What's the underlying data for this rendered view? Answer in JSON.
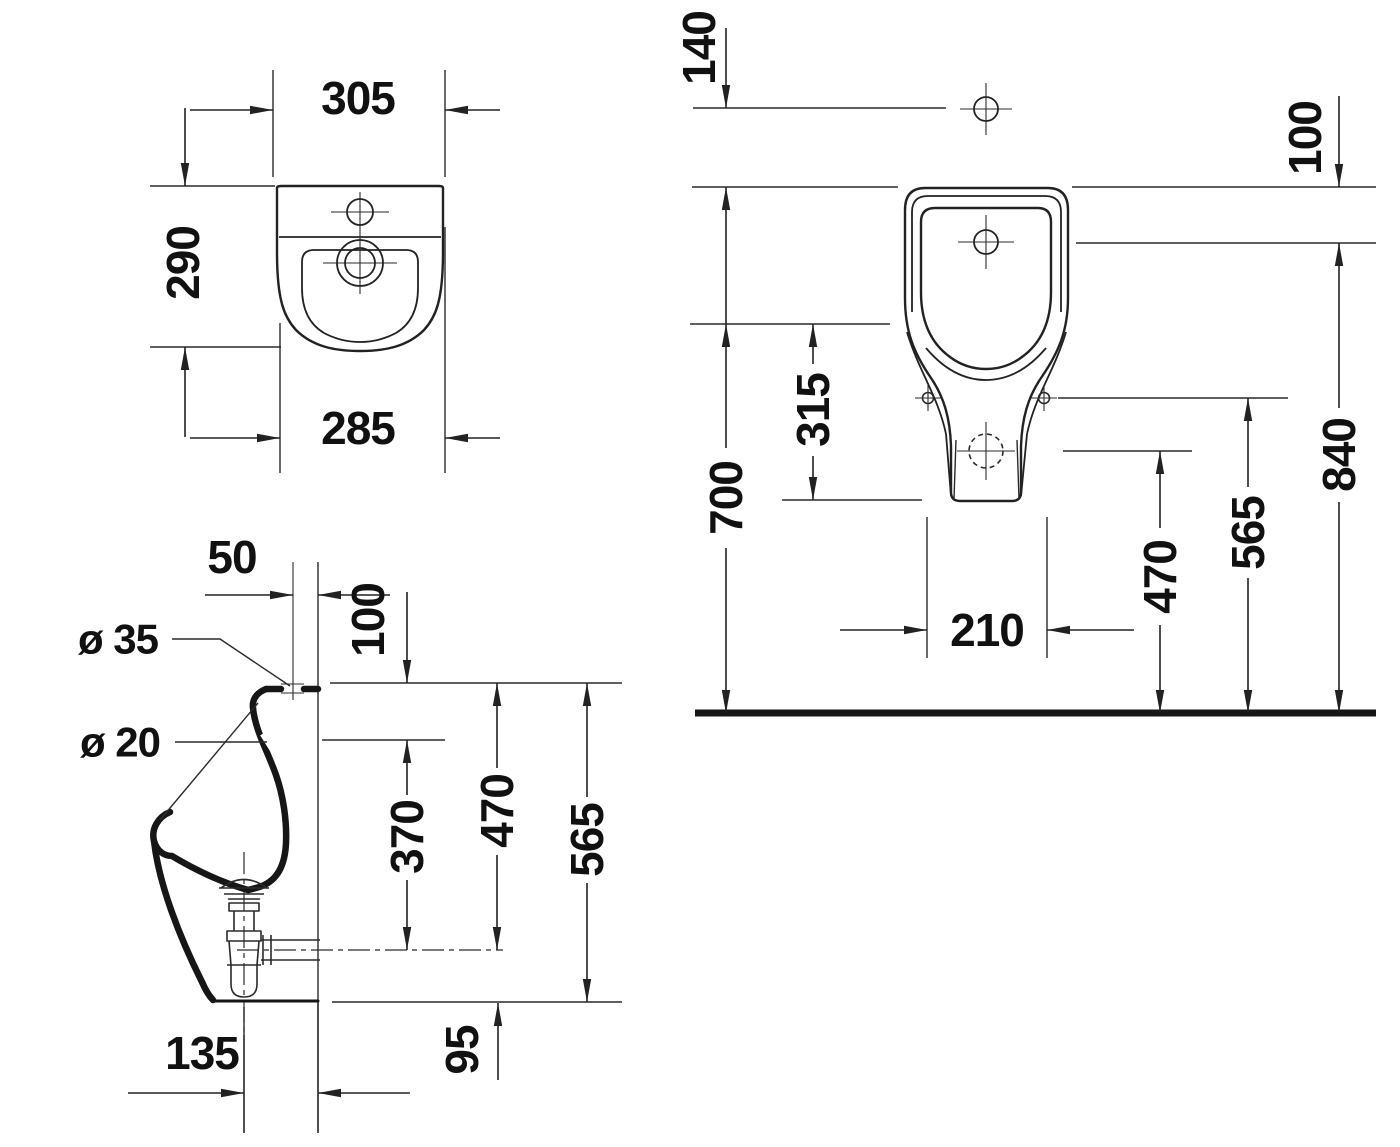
{
  "drawing": {
    "title": "Wall-hung urinal technical drawing, three orthographic views, dimensions in mm",
    "colors": {
      "background": "#ffffff",
      "line": "#222222",
      "text": "#111111"
    }
  },
  "plan": {
    "width_top": "305",
    "depth": "290",
    "width_bottom": "285"
  },
  "side": {
    "inlet_to_wall": "50",
    "rim_hole_drop": "100",
    "inlet_diameter": "ø 35",
    "rim_hole_diameter": "ø 20",
    "drain_drop": "370",
    "outlet_axis_drop": "470",
    "body_height": "565",
    "bottom_clearance": "95",
    "trap_to_wall": "135"
  },
  "front": {
    "holder_above_top": "140",
    "inlet_below_top": "100",
    "fixing_drop": "315",
    "rim_to_floor": "700",
    "fixing_hole_span": "210",
    "outlet_to_floor": "470",
    "fixing_to_floor": "565",
    "inlet_to_floor": "840"
  }
}
